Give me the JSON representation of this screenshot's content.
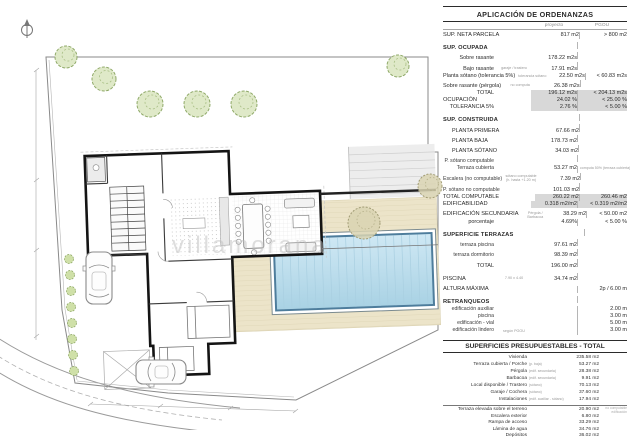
{
  "plan": {
    "watermark": "villamorana"
  },
  "ordenanzas": {
    "title": "APLICACIÓN DE ORDENANZAS",
    "col_proyecto": "proyecto",
    "col_pgou": "PGOU",
    "rows": [
      {
        "cls": "main",
        "label": "SUP. NETA PARCELA",
        "v1": "817 m2",
        "v2": "> 800 m2"
      },
      {
        "cls": "sec gap",
        "label": "SUP. OCUPADA"
      },
      {
        "cls": "sub",
        "label": "Sobre rasante",
        "v1": "178.22 m2s"
      },
      {
        "cls": "sub",
        "label": "Bajo rasante",
        "note": "garaje / trastero",
        "v1": "17.91 m2s"
      },
      {
        "cls": "sub",
        "label": "Planta sótano (tolerancia 5%)",
        "note": "tolerancia sótano",
        "v1": "22.50 m2s",
        "v2": "< 60.83 m2s"
      },
      {
        "cls": "sub",
        "label": "Sobre rasante (pérgola)",
        "note": "no computa",
        "v1": "26.38 m2s"
      },
      {
        "cls": "sub hl",
        "label": "TOTAL",
        "v1": "196.12 m2s",
        "v2": "< 204.13 m2s"
      },
      {
        "cls": "main hl",
        "label": "OCUPACIÓN",
        "v1": "24.02 %",
        "v2": "< 25.00 %"
      },
      {
        "cls": "sub hl",
        "label": "TOLERANCIA 5%",
        "v1": "2.76 %",
        "v2": "< 5.00 %"
      },
      {
        "cls": "sec gap",
        "label": "SUP. CONSTRUIDA"
      },
      {
        "cls": "ind",
        "label": "PLANTA PRIMERA",
        "v1": "67.66 m2"
      },
      {
        "cls": "ind",
        "label": "PLANTA BAJA",
        "v1": "178.73 m2"
      },
      {
        "cls": "ind",
        "label": "PLANTA SÓTANO",
        "v1": "34.03 m2"
      },
      {
        "cls": "sub2",
        "label": "P. sótano computable"
      },
      {
        "cls": "sub2",
        "label": "Terraza cubierta",
        "v1": "53.27 m2",
        "n2": "computa 50% (terraza cubierta)"
      },
      {
        "cls": "sub2",
        "label": "Escalera (no computable)",
        "note": "sótano computable (h. hasta +1.20 m)",
        "v1": "7.39 m2"
      },
      {
        "cls": "sub2",
        "label": "P. sótano no computable",
        "v1": "101.03 m2"
      },
      {
        "cls": "sub hl",
        "label": "TOTAL COMPUTABLE",
        "v1": "260.22 m2",
        "v2": "260.46 m2"
      },
      {
        "cls": "main hl",
        "label": "EDIFICABILIDAD",
        "v1": "0.318 m2/m2",
        "v2": "< 0.319 m2/m2"
      },
      {
        "cls": "main gap",
        "label": "EDIFICACIÓN SECUNDARIA",
        "note": "Pérgola / Barbacoa",
        "v1": "38.29 m2",
        "v2": "< 50.00 m2"
      },
      {
        "cls": "sub",
        "label": "porcentaje",
        "v1": "4.69%",
        "v2": "< 5.00 %"
      },
      {
        "cls": "sec gap",
        "label": "SUPERFICIE TERRAZAS"
      },
      {
        "cls": "sub2",
        "label": "terraza piscina",
        "v1": "97.61 m2"
      },
      {
        "cls": "sub2",
        "label": "terraza dormitorio",
        "v1": "98.39 m2"
      },
      {
        "cls": "sub",
        "label": "TOTAL",
        "v1": "196.00 m2"
      },
      {
        "cls": "main gap",
        "label": "PISCINA",
        "note": "7.90 x 4.40",
        "v1": "34.74 m2"
      },
      {
        "cls": "main gap",
        "label": "ALTURA MÁXIMA",
        "v2": "2p / 6.00 m"
      },
      {
        "cls": "sec gap",
        "label": "RETRANQUEOS"
      },
      {
        "cls": "sub2",
        "label": "edificación auxiliar",
        "v2": "2.00 m"
      },
      {
        "cls": "sub2",
        "label": "piscina",
        "v2": "3.00 m"
      },
      {
        "cls": "sub2",
        "label": "edificación - vial",
        "v2": "5.00 m"
      },
      {
        "cls": "sub2",
        "label": "edificación lindero",
        "note": "según PGOU",
        "v2": "3.00 m"
      }
    ]
  },
  "presupuestables": {
    "title": "SUPERFICIES PRESUPUESTABLES - TOTAL",
    "rows": [
      {
        "label": "Vivienda",
        "value": "235.58 m2"
      },
      {
        "label": "Terraza cubierta / Porche",
        "note": "(p. baja)",
        "value": "53.27 m2"
      },
      {
        "label": "Pérgola",
        "note": "(edif. secundaria)",
        "value": "28.38 m2"
      },
      {
        "label": "Barbacoa",
        "note": "(edif. secundaria)",
        "value": "9.91 m2"
      },
      {
        "label": "Local disponible / Trastero",
        "note": "(sótano)",
        "value": "70.13 m2"
      },
      {
        "label": "Garaje / Cochera",
        "note": "(sótano)",
        "value": "37.60 m2"
      },
      {
        "label": "Instalaciones",
        "note": "(edif. auxiliar - sótano)",
        "value": "17.94 m2"
      },
      {
        "cls": "rule",
        "label": "Terraza elevada sobre el terreno",
        "value": "20.90 m2",
        "note2": "no computable edificación"
      },
      {
        "label": "Escalera exterior",
        "value": "6.80 m2"
      },
      {
        "label": "Rampa de acceso",
        "value": "33.29 m2"
      },
      {
        "label": "Lámina de agua",
        "value": "34.76 m2"
      },
      {
        "label": "Depósitos",
        "value": "36.02 m2"
      }
    ]
  }
}
